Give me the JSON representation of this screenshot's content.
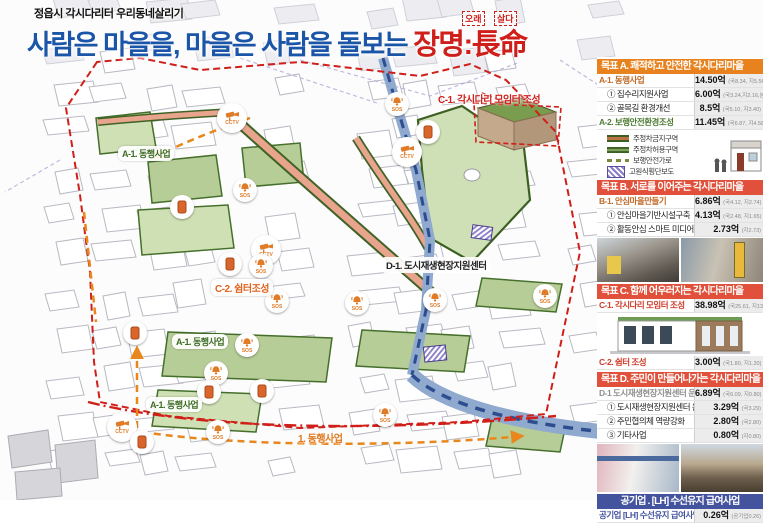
{
  "header": {
    "small_title": "정읍시 각시다리터 우리동네살리기",
    "main_title_prefix": "사람은 마을을, 마을은 사람을 돌보는 ",
    "main_title_highlight": "장명:長命",
    "annotation_left": "오래",
    "annotation_right": "살다",
    "title_color": "#1b55a8",
    "highlight_color": "#cf1f1a"
  },
  "map": {
    "cctv_label": "CCTV",
    "sos_label": "SOS",
    "labels": [
      {
        "text": "A-1. 동행사업",
        "x": 118,
        "y": 146,
        "style": "pill-green"
      },
      {
        "text": "C-1. 각시다리 모임터 조성",
        "x": 438,
        "y": 91,
        "style": "red"
      },
      {
        "text": "D-1. 도시재생현장지원센터",
        "x": 383,
        "y": 257,
        "style": "pill-black"
      },
      {
        "text": "C-2. 쉼터조성",
        "x": 211,
        "y": 279,
        "style": "pill-orange"
      },
      {
        "text": "A-1. 동행사업",
        "x": 172,
        "y": 334,
        "style": "pill-green"
      },
      {
        "text": "A-1. 동행사업",
        "x": 146,
        "y": 397,
        "style": "pill-green"
      },
      {
        "text": "1. 동행사업",
        "x": 298,
        "y": 430,
        "style": "orange"
      }
    ],
    "markers": [
      {
        "type": "cctv",
        "x": 232,
        "y": 118
      },
      {
        "type": "cctv",
        "x": 407,
        "y": 152
      },
      {
        "type": "cctv",
        "x": 266,
        "y": 250
      },
      {
        "type": "cctv",
        "x": 122,
        "y": 427
      },
      {
        "type": "sos",
        "x": 397,
        "y": 104
      },
      {
        "type": "sos",
        "x": 261,
        "y": 266
      },
      {
        "type": "sos",
        "x": 277,
        "y": 301
      },
      {
        "type": "sos",
        "x": 357,
        "y": 303
      },
      {
        "type": "sos",
        "x": 435,
        "y": 300
      },
      {
        "type": "sos",
        "x": 247,
        "y": 345
      },
      {
        "type": "sos",
        "x": 216,
        "y": 373
      },
      {
        "type": "sos",
        "x": 218,
        "y": 432
      },
      {
        "type": "sos",
        "x": 385,
        "y": 415
      },
      {
        "type": "sos",
        "x": 545,
        "y": 296
      },
      {
        "type": "sos",
        "x": 245,
        "y": 190
      },
      {
        "type": "door",
        "x": 428,
        "y": 132
      },
      {
        "type": "door",
        "x": 230,
        "y": 264
      },
      {
        "type": "door",
        "x": 209,
        "y": 392
      },
      {
        "type": "door",
        "x": 262,
        "y": 391
      },
      {
        "type": "door",
        "x": 142,
        "y": 442
      },
      {
        "type": "door",
        "x": 182,
        "y": 207
      },
      {
        "type": "door",
        "x": 135,
        "y": 333
      }
    ]
  },
  "sidebar": {
    "goalA": {
      "header": "목표 A. 쾌적하고 안전한 각시다리마을",
      "header_color": "#e8821e",
      "rows": [
        {
          "label": "A-1. 동행사업",
          "value": "14.50억",
          "detail": "(국8.34, 지5.56)"
        },
        {
          "label": "① 집수리지원사업",
          "value": "6.00억",
          "detail": "(국3.24,지2.16,본0.60)"
        },
        {
          "label": "② 골목길 환경개선",
          "value": "8.5억",
          "detail": "(국5.10, 지3.40)"
        },
        {
          "label": "A-2. 보행안전환경조성",
          "value": "11.45억",
          "detail": "(국6.87, 지4.58)"
        }
      ],
      "legend": [
        {
          "label": "주정차금지구역"
        },
        {
          "label": "주정차허용구역"
        },
        {
          "label": "보행안전가로"
        },
        {
          "label": "고원식횡단보도"
        }
      ]
    },
    "goalB": {
      "header": "목표 B. 서로를 이어주는 각시다리마을",
      "header_color": "#e0503a",
      "rows": [
        {
          "label": "B-1. 안심마을만들기",
          "value": "6.86억",
          "detail": "(국4.12, 지2.74)"
        },
        {
          "label": "① 안심마을기반시설구축",
          "value": "4.13억",
          "detail": "(국2.48, 지1.65)"
        },
        {
          "label": "② 활동안심 스마트 미디어월",
          "value": "2.73억",
          "detail": "(지2.73)"
        }
      ]
    },
    "goalC": {
      "header": "목표 C. 함께 어우러지는 각시다리마을",
      "header_color": "#e0503a",
      "rows": [
        {
          "label": "C-1. 각시다리 모임터 조성",
          "value": "38.98억",
          "detail": "(국25.61, 지13.37)"
        },
        {
          "label": "C-2. 쉼터 조성",
          "value": "3.00억",
          "detail": "(국1.80, 지1.20)"
        }
      ]
    },
    "goalD": {
      "header": "목표 D. 주민이 만들어나가는 각시다리마을",
      "header_color": "#e0503a",
      "rows": [
        {
          "label": "D-1 도시재생현장지원센터 운영",
          "value": "6.89억",
          "detail": "(국6.09, 지0.80)"
        },
        {
          "label": "① 도시재생현장지원센터 운영",
          "value": "3.29억",
          "detail": "(국3.29)"
        },
        {
          "label": "② 주민협의체 역량강화",
          "value": "2.80억",
          "detail": "(국2.80)"
        },
        {
          "label": "③ 기타사업",
          "value": "0.80억",
          "detail": "(지0.80)"
        }
      ]
    },
    "lh": {
      "header": "공기업 . [LH] 수선유지 급여사업",
      "header_color": "#44539e",
      "rows": [
        {
          "label": "공기업 [LH] 수선유지 급여사업",
          "value": "0.26억",
          "detail": "(공기업0.26)"
        }
      ]
    }
  }
}
